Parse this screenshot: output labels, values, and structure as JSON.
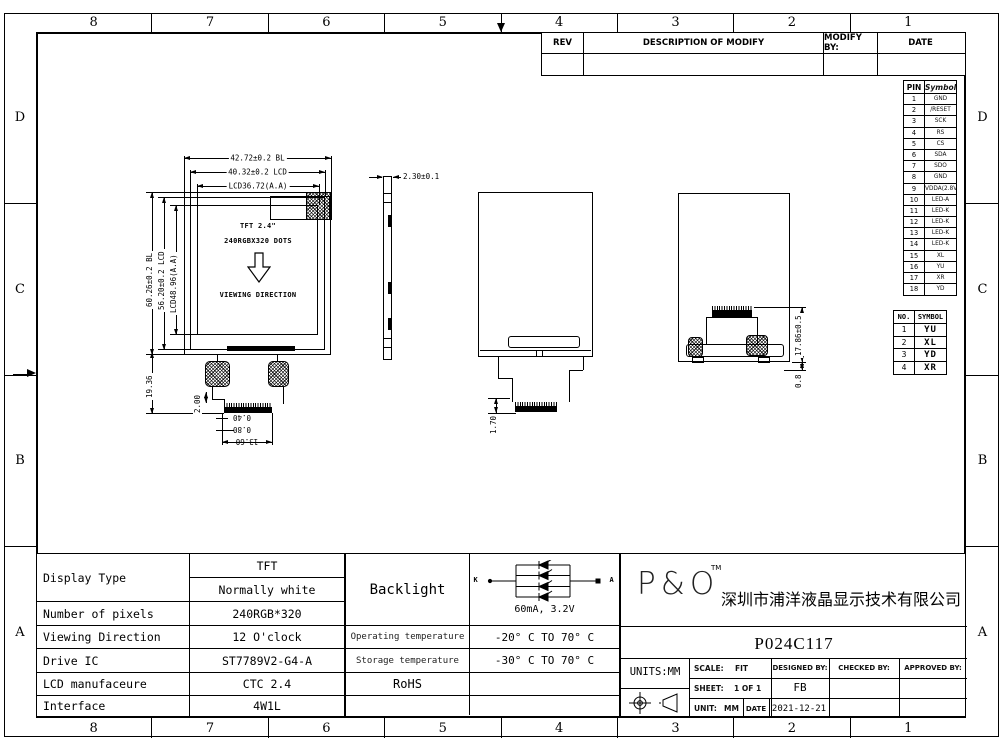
{
  "border": {
    "cols": [
      "8",
      "7",
      "6",
      "5",
      "4",
      "3",
      "2",
      "1"
    ],
    "rows": [
      "D",
      "C",
      "B",
      "A"
    ]
  },
  "rev_table": {
    "headers": [
      "REV",
      "DESCRIPTION OF MODIFY",
      "MODIFY BY:",
      "DATE"
    ]
  },
  "pin_table": {
    "headers": [
      "PIN",
      "Symbol"
    ],
    "rows": [
      [
        "1",
        "GND"
      ],
      [
        "2",
        "/RESET"
      ],
      [
        "3",
        "SCK"
      ],
      [
        "4",
        "RS"
      ],
      [
        "5",
        "CS"
      ],
      [
        "6",
        "SDA"
      ],
      [
        "7",
        "SDO"
      ],
      [
        "8",
        "GND"
      ],
      [
        "9",
        "VDDA(2.8V)"
      ],
      [
        "10",
        "LED-A"
      ],
      [
        "11",
        "LED-K"
      ],
      [
        "12",
        "LED-K"
      ],
      [
        "13",
        "LED-K"
      ],
      [
        "14",
        "LED-K"
      ],
      [
        "15",
        "XL"
      ],
      [
        "16",
        "YU"
      ],
      [
        "17",
        "XR"
      ],
      [
        "18",
        "YD"
      ]
    ]
  },
  "no_table": {
    "headers": [
      "NO.",
      "SYMBOL"
    ],
    "rows": [
      [
        "1",
        "YU"
      ],
      [
        "2",
        "XL"
      ],
      [
        "3",
        "YD"
      ],
      [
        "4",
        "XR"
      ]
    ]
  },
  "front_view": {
    "dim_width_bl": "42.72±0.2 BL",
    "dim_width_lcd": "40.32±0.2 LCD",
    "dim_width_aa": "LCD36.72(A.A)",
    "dim_height_bl": "60.26±0.2 BL",
    "dim_height_lcd": "56.20±0.2 LCD",
    "dim_height_aa": "LCD48.96(A.A)",
    "dim_tail": "19.36",
    "dim_fpc_step": "2.00",
    "dim_pin_pitch": "0.40",
    "dim_pin_width": "0.80",
    "dim_connector_width": "13.60",
    "line1": "TFT 2.4\"",
    "line2": "240RGBX320 DOTS",
    "line3": "VIEWING DIRECTION"
  },
  "side_view": {
    "dim_thickness": "2.30±0.1"
  },
  "middle_view": {
    "dim_fpc": "1.70"
  },
  "back_view": {
    "dim_height": "17.86±0.5",
    "dim_offset": "0.8"
  },
  "spec_table": {
    "display_type_label": "Display Type",
    "display_type_value1": "TFT",
    "display_type_value2": "Normally white",
    "pixels_label": "Number of pixels",
    "pixels_value": "240RGB*320",
    "viewing_label": "Viewing Direction",
    "viewing_value": "12 O'clock",
    "drive_label": "Drive IC",
    "drive_value": "ST7789V2-G4-A",
    "manufacture_label": "LCD manufaceure",
    "manufacture_value": "CTC 2.4",
    "interface_label": "Interface",
    "interface_value": "4W1L"
  },
  "env_table": {
    "backlight_label": "Backlight",
    "k_label": "K",
    "a_label": "A",
    "current": "60mA, 3.2V",
    "op_label": "Operating temperature",
    "op_value": "-20° C TO 70° C",
    "st_label": "Storage temperature",
    "st_value": "-30° C TO 70° C",
    "rohs_label": "RoHS"
  },
  "title_block": {
    "logo": "P&O",
    "tm": "TM",
    "company": "深圳市浦洋液晶显示技术有限公司",
    "part_number": "P024C117",
    "units": "UNITS:MM",
    "scale_label": "SCALE:",
    "scale_value": "FIT",
    "designed_label": "DESIGNED BY:",
    "designed_value": "FB",
    "checked_label": "CHECKED BY:",
    "approved_label": "APPROVED BY:",
    "sheet_label": "SHEET:",
    "sheet_value": "1 OF 1",
    "unit_label": "UNIT:",
    "unit_value": "MM",
    "date_label": "DATE",
    "date_value": "2021-12-21"
  }
}
